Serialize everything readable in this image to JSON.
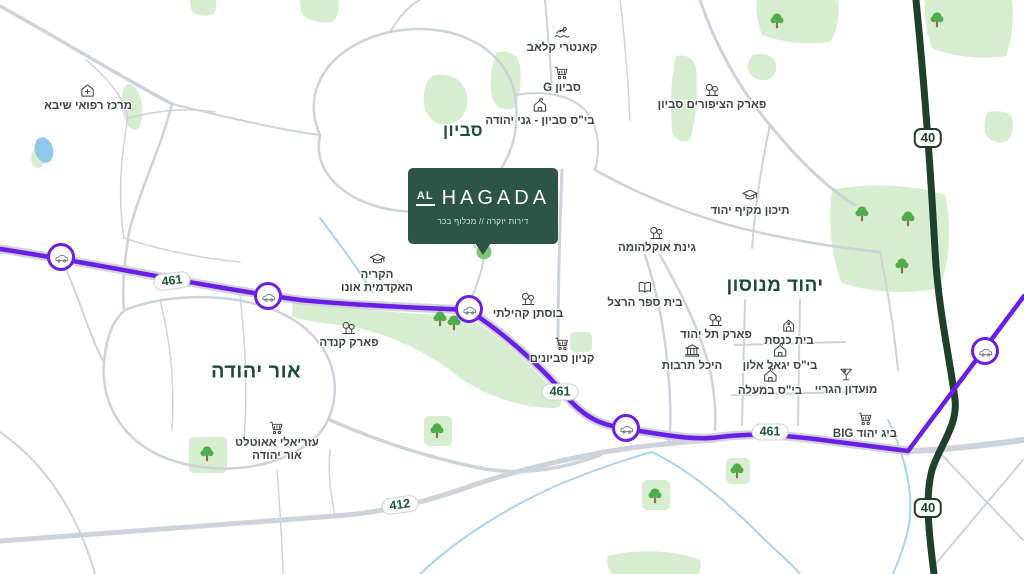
{
  "brand": {
    "logo_prefix": "AL",
    "logo_name": "HAGADA",
    "tagline": "דירות יוקרה // מכלוף בכר"
  },
  "palette": {
    "route_461": "#6c1de6",
    "route_40": "#20402e",
    "road": "#ccd3da",
    "green_area": "#d6eecf",
    "water": "#a9d4ee",
    "area_label": "#1c4e37",
    "poi_label": "#3c453f",
    "badge_text": "#1b5a38",
    "brand_box": "#2d5547",
    "tree": "#4fae4a"
  },
  "map": {
    "area_labels": [
      {
        "id": "savyon",
        "text": "סביון",
        "x": 463,
        "y": 131,
        "size": 17
      },
      {
        "id": "yehud-monosson",
        "text": "יהוד מנוסון",
        "x": 775,
        "y": 286,
        "size": 19
      },
      {
        "id": "or-yehuda",
        "text": "אור יהודה",
        "x": 256,
        "y": 372,
        "size": 20
      }
    ],
    "pois": [
      {
        "id": "sheba-medical-center",
        "icon": "medical",
        "label": "מרכז רפואי שיבא",
        "x": 88,
        "y": 82
      },
      {
        "id": "country-club",
        "icon": "swimmer",
        "label": "קאנטרי קלאב",
        "x": 562,
        "y": 24
      },
      {
        "id": "g-savyon",
        "icon": "cart",
        "label": "סביון G",
        "x": 562,
        "y": 64
      },
      {
        "id": "savyon-ganei-yehuda-school",
        "icon": "school",
        "label": "בי\"ס סביון - גני יהודה",
        "x": 540,
        "y": 97
      },
      {
        "id": "birds-park-savyon",
        "icon": "park",
        "label": "פארק הציפורים סביון",
        "x": 712,
        "y": 81
      },
      {
        "id": "yehud-high-school",
        "icon": "gradcap",
        "label": "תיכון מקיף יהוד",
        "x": 750,
        "y": 187
      },
      {
        "id": "oklahoma-garden",
        "icon": "park",
        "label": "גינת אוקלהומה",
        "x": 657,
        "y": 224
      },
      {
        "id": "herzl-school",
        "icon": "book",
        "label": "בית ספר הרצל",
        "x": 645,
        "y": 279
      },
      {
        "id": "ono-academic-college",
        "icon": "gradcap",
        "label": "הקריה\nהאקדמית אונו",
        "x": 377,
        "y": 251
      },
      {
        "id": "community-orchard",
        "icon": "park",
        "label": "בוסתן קהילתי",
        "x": 528,
        "y": 290
      },
      {
        "id": "canada-park",
        "icon": "park",
        "label": "פארק קנדה",
        "x": 349,
        "y": 319
      },
      {
        "id": "savyonim-mall",
        "icon": "cart",
        "label": "קניון סביונים",
        "x": 562,
        "y": 335
      },
      {
        "id": "tel-yehud-park",
        "icon": "park",
        "label": "פארק תל יהוד",
        "x": 716,
        "y": 311
      },
      {
        "id": "culture-hall",
        "icon": "bank",
        "label": "היכל תרבות",
        "x": 692,
        "y": 342
      },
      {
        "id": "synagogue",
        "icon": "synagogue",
        "label": "בית כנסת",
        "x": 789,
        "y": 317
      },
      {
        "id": "yigal-alon-school",
        "icon": "school",
        "label": "בי\"ס יגאל אלון",
        "x": 780,
        "y": 342
      },
      {
        "id": "bemaale-school",
        "icon": "school",
        "label": "בי\"ס במעלה",
        "x": 770,
        "y": 367
      },
      {
        "id": "gray-club",
        "icon": "martini",
        "label": "מועדון הגריי",
        "x": 846,
        "y": 366
      },
      {
        "id": "big-yehud",
        "icon": "cart",
        "label": "ביג יהוד BIG",
        "x": 865,
        "y": 410
      },
      {
        "id": "azrieli-outlet",
        "icon": "cart",
        "label": "עזריאלי אאוטלט\nאור יהודה",
        "x": 277,
        "y": 419
      }
    ],
    "road_badges": [
      {
        "id": "461-west",
        "type": "pill",
        "text": "461",
        "x": 172,
        "y": 281,
        "rot": -7
      },
      {
        "id": "461-center",
        "type": "pill",
        "text": "461",
        "x": 560,
        "y": 392,
        "rot": 0
      },
      {
        "id": "461-east",
        "type": "pill",
        "text": "461",
        "x": 770,
        "y": 432,
        "rot": 0
      },
      {
        "id": "412",
        "type": "pill",
        "text": "412",
        "x": 400,
        "y": 505,
        "rot": -8
      },
      {
        "id": "40-north",
        "type": "shield",
        "text": "40",
        "x": 928,
        "y": 138,
        "rot": 0
      },
      {
        "id": "40-south",
        "type": "shield",
        "text": "40",
        "x": 928,
        "y": 508,
        "rot": 0
      }
    ],
    "interchanges": [
      {
        "id": "ic-1",
        "x": 61,
        "y": 257
      },
      {
        "id": "ic-2",
        "x": 268,
        "y": 296
      },
      {
        "id": "ic-3",
        "x": 469,
        "y": 309
      },
      {
        "id": "ic-4",
        "x": 626,
        "y": 428
      },
      {
        "id": "ic-5",
        "x": 985,
        "y": 351
      }
    ],
    "trees": [
      {
        "x": 777,
        "y": 12
      },
      {
        "x": 937,
        "y": 11
      },
      {
        "x": 862,
        "y": 205
      },
      {
        "x": 908,
        "y": 210
      },
      {
        "x": 902,
        "y": 257
      },
      {
        "x": 440,
        "y": 310
      },
      {
        "x": 454,
        "y": 314
      },
      {
        "x": 207,
        "y": 445
      },
      {
        "x": 437,
        "y": 422
      },
      {
        "x": 655,
        "y": 487
      },
      {
        "x": 737,
        "y": 462
      }
    ]
  }
}
